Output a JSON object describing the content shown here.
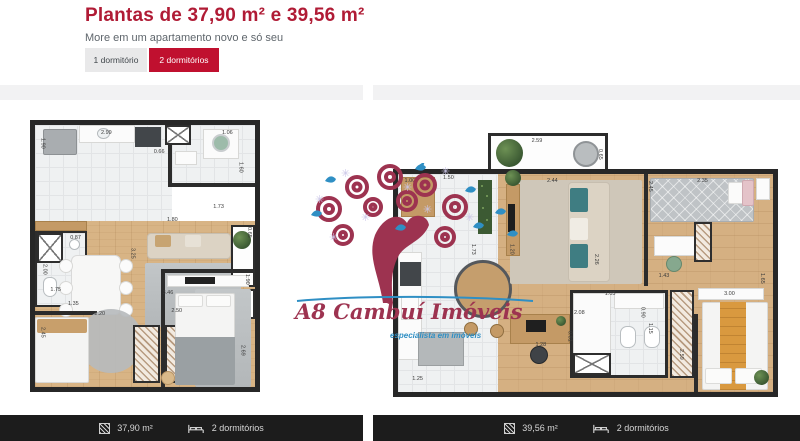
{
  "header": {
    "title": "Plantas de 37,90 m² e 39,56 m²",
    "subtitle": "More em um apartamento novo e só seu",
    "tabs": [
      {
        "label": "1 dormitório",
        "active": false
      },
      {
        "label": "2 dormitórios",
        "active": true
      }
    ]
  },
  "watermark": {
    "brand": "A8 Cambuí Imóveis",
    "tagline": "especialista em imóveis"
  },
  "colors": {
    "accent_title": "#b01b35",
    "tab_active": "#c0102f",
    "tab_inactive_bg": "#e9e9ea",
    "footer_bg": "#1c1c1c",
    "brand_maroon": "#9d3350",
    "brand_blue": "#2f8fc4"
  },
  "plans": [
    {
      "footer": {
        "area": "37,90 m²",
        "bedrooms": "2 dormitórios"
      },
      "dims": [
        {
          "t": "1.90",
          "l": 2,
          "tp": 5,
          "v": true
        },
        {
          "t": "2.99",
          "l": 30,
          "tp": 2,
          "v": false
        },
        {
          "t": "0.66",
          "l": 54,
          "tp": 9,
          "v": false
        },
        {
          "t": "1.06",
          "l": 85,
          "tp": 2,
          "v": false
        },
        {
          "t": "1.60",
          "l": 92,
          "tp": 14,
          "v": true
        },
        {
          "t": "1.73",
          "l": 81,
          "tp": 30,
          "v": false
        },
        {
          "t": "1.80",
          "l": 60,
          "tp": 35,
          "v": false
        },
        {
          "t": "0.65",
          "l": 96,
          "tp": 39,
          "v": true
        },
        {
          "t": "0.87",
          "l": 16,
          "tp": 42,
          "v": false
        },
        {
          "t": "2.00",
          "l": 3,
          "tp": 53,
          "v": true
        },
        {
          "t": "3.25",
          "l": 43,
          "tp": 47,
          "v": true
        },
        {
          "t": "1.75",
          "l": 7,
          "tp": 62,
          "v": false
        },
        {
          "t": "1.35",
          "l": 15,
          "tp": 67,
          "v": false
        },
        {
          "t": "2.20",
          "l": 27,
          "tp": 71,
          "v": false
        },
        {
          "t": "2.45",
          "l": 2,
          "tp": 77,
          "v": true
        },
        {
          "t": "3.46",
          "l": 58,
          "tp": 63,
          "v": false
        },
        {
          "t": "2.50",
          "l": 62,
          "tp": 70,
          "v": false
        },
        {
          "t": "1.90",
          "l": 95,
          "tp": 57,
          "v": true
        },
        {
          "t": "2.69",
          "l": 93,
          "tp": 84,
          "v": true
        }
      ]
    },
    {
      "footer": {
        "area": "39,56 m²",
        "bedrooms": "2 dormitórios"
      },
      "dims": [
        {
          "t": "2.59",
          "l": 36,
          "tp": 2,
          "v": false
        },
        {
          "t": "0.65",
          "l": 53,
          "tp": 6,
          "v": true
        },
        {
          "t": "1.00",
          "l": 3,
          "tp": 17,
          "v": false
        },
        {
          "t": "1.50",
          "l": 13,
          "tp": 16,
          "v": false
        },
        {
          "t": "2.44",
          "l": 40,
          "tp": 17,
          "v": false
        },
        {
          "t": "2.45",
          "l": 66,
          "tp": 18,
          "v": true
        },
        {
          "t": "2.35",
          "l": 79,
          "tp": 17,
          "v": false
        },
        {
          "t": "1.73",
          "l": 20,
          "tp": 42,
          "v": true
        },
        {
          "t": "1.20",
          "l": 30,
          "tp": 42,
          "v": true
        },
        {
          "t": "2.26",
          "l": 52,
          "tp": 46,
          "v": true
        },
        {
          "t": "1.43",
          "l": 69,
          "tp": 53,
          "v": false
        },
        {
          "t": "1.65",
          "l": 95,
          "tp": 53,
          "v": true
        },
        {
          "t": "1.05",
          "l": 55,
          "tp": 60,
          "v": false
        },
        {
          "t": "0.90",
          "l": 64,
          "tp": 66,
          "v": true
        },
        {
          "t": "3.00",
          "l": 86,
          "tp": 60,
          "v": false
        },
        {
          "t": "2.08",
          "l": 47,
          "tp": 67,
          "v": false
        },
        {
          "t": "0.81",
          "l": 45,
          "tp": 75,
          "v": true
        },
        {
          "t": "1.15",
          "l": 66,
          "tp": 72,
          "v": true
        },
        {
          "t": "1.25",
          "l": 5,
          "tp": 92,
          "v": false
        },
        {
          "t": "1.28",
          "l": 37,
          "tp": 79,
          "v": false
        },
        {
          "t": "2.59",
          "l": 74,
          "tp": 82,
          "v": true
        }
      ]
    }
  ]
}
